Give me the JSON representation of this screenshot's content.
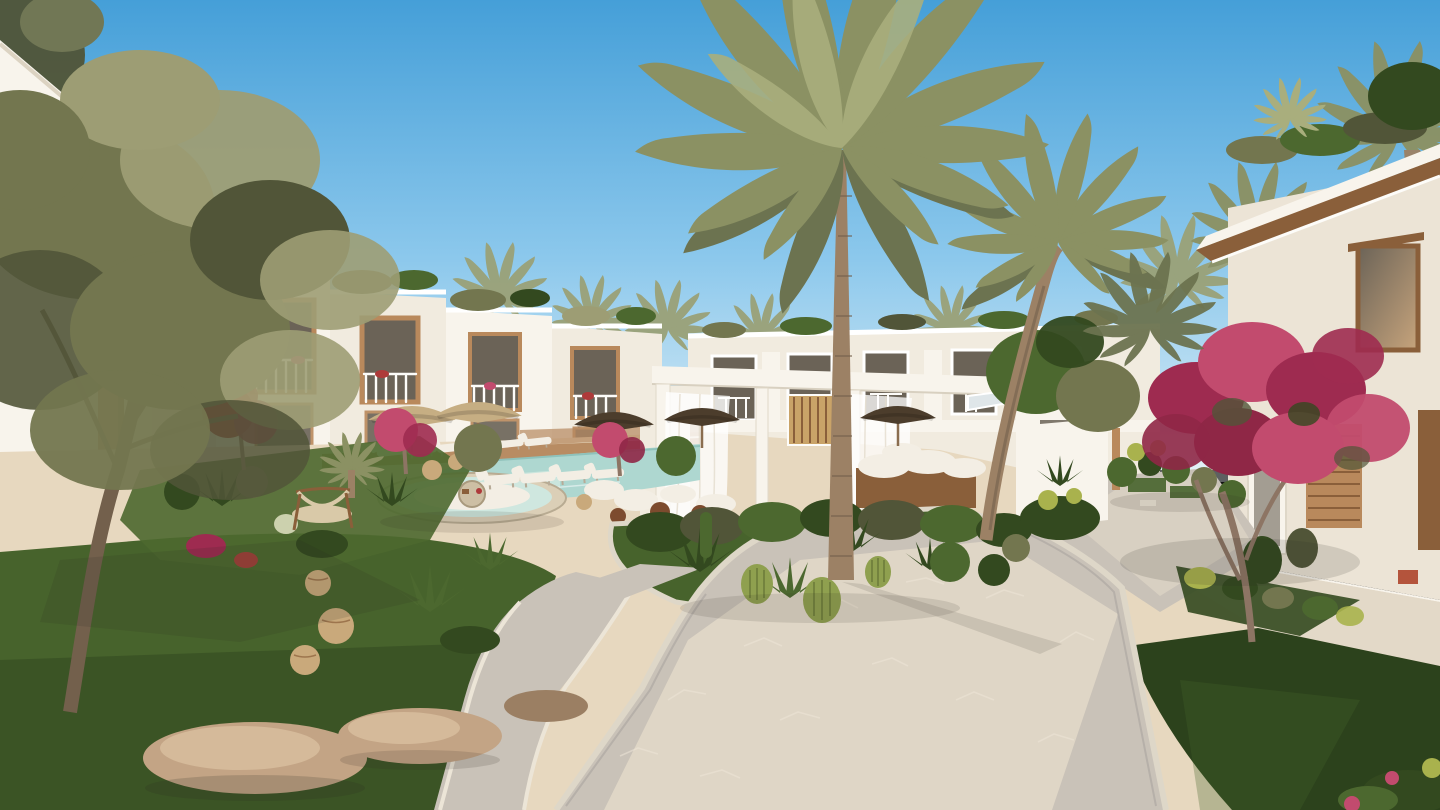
{
  "meta": {
    "width_px": 1440,
    "height_px": 810,
    "kind": "architectural-render"
  },
  "scene": {
    "description": "Sunlit rendering of a Mediterranean-style resort courtyard: white two-storey townhouses with timber accents surround a landscaped plaza with a swimming pool, sun loungers, straw umbrellas, a curtained pergola lounge, a large date palm, an olive tree, pink bougainvillea, cactus beds, lawns and winding flagstone paths under a clear blue sky.",
    "lighting": "low warm sunlight from the left, clear sky",
    "elements": [
      "sky",
      "background-palms",
      "white-townhouse-row",
      "middle-townhouse-row",
      "right-villa",
      "pergola-lounge",
      "sheer-curtains",
      "cabana",
      "daybed",
      "swimming-pool",
      "sunken-lounge",
      "sun-loungers",
      "straw-umbrellas",
      "floor-cushions",
      "leather-poufs",
      "garden-island",
      "cacti-and-agaves",
      "trimmed-bushes",
      "olive-tree",
      "bougainvillea-tree",
      "flowering-trees",
      "rattan-lanterns",
      "hammock-chair",
      "boulders",
      "lawns",
      "flagstone-paths",
      "rooftop-planters",
      "wood-shutters",
      "garden-wall"
    ]
  },
  "colors": {
    "sky_top": "#459fd8",
    "sky_mid": "#8cc8ec",
    "sky_horizon": "#dceef6",
    "haze": "#eef6f9",
    "wall_sunlit": "#f8f4ec",
    "wall_light": "#f1ebdf",
    "wall_shade": "#e4dccd",
    "wall_cream": "#ece4d6",
    "wood": "#b9895c",
    "wood_dark": "#8a5f3a",
    "wood_slat": "#c9a368",
    "glass_dark": "#6b6357",
    "glass_warm": "#c7a47c",
    "railing_white": "#fdfcf9",
    "palm_green": "#8b9163",
    "palm_dark": "#6c7350",
    "palm_light": "#a9ae7d",
    "palm_muted": "#9aa178",
    "trunk": "#9c8165",
    "trunk_dark": "#73604c",
    "branch": "#8d7564",
    "olive_leaf": "#73764f",
    "olive_light": "#9d9d74",
    "olive_dark": "#515538",
    "green_dark": "#33491f",
    "green_mid": "#4c682f",
    "green_light": "#6f8f3c",
    "yellow_green": "#a9b24d",
    "grass": "#47632c",
    "grass_dark": "#2c421c",
    "grass_light": "#5c7c34",
    "flower_pink": "#c24b6e",
    "flower_magenta": "#9e2b50",
    "flower_deep": "#8f2746",
    "flower_red": "#ae3a3a",
    "deck_sand": "#e7d8bf",
    "deck_sand_light": "#f1e4cb",
    "path_stone": "#c9c2b8",
    "path_sun": "#e3d9c8",
    "path_shade": "#aaa49f",
    "curb": "#ded7c8",
    "gravel": "#ece5d7",
    "pool_water": "#aed7d0",
    "pool_light": "#cfe7df",
    "pool_deep": "#8fc2bb",
    "wood_deck": "#b5885e",
    "umbrella_straw": "#c6ae83",
    "umbrella_dark": "#4c3d2c",
    "cushion_white": "#f3eee4",
    "pouf_brown": "#7d4b2e",
    "rock": "#c3a485",
    "rock_shade": "#9b7f63",
    "lantern": "#c9a97b",
    "hammock": "#d9c9a8",
    "lounge_rim": "#dbcfb7",
    "barrel_cactus": "#8fa04f",
    "cactus_line": "#6d7c3a",
    "pale_cactus": "#ccd1ae",
    "terracotta": "#b4543c",
    "shadow": "#2e2a24"
  }
}
